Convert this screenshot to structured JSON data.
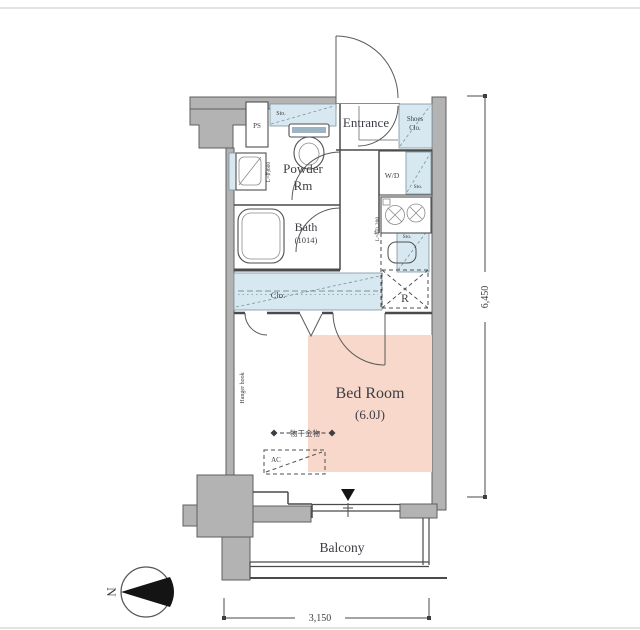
{
  "colors": {
    "wall": "#b3b3b3",
    "line": "#4a4a4a",
    "storage_hatch": "#d7e8f1",
    "bedroom_highlight": "#f8d8ca",
    "page_border": "#d8d8d8",
    "text": "#3d3d45"
  },
  "rooms": {
    "entrance": "Entrance",
    "shoes_closet_line1": "Shoes",
    "shoes_closet_line2": "Clo.",
    "powder_line1": "Powder",
    "powder_line2": "Rm",
    "bath": "Bath",
    "bath_size": "(1014)",
    "bedroom": "Bed Room",
    "bedroom_size": "(6.0J)",
    "balcony": "Balcony",
    "closet": "Clo."
  },
  "fixtures": {
    "pipe_space": "PS",
    "washer_dryer": "W/D",
    "refrigerator": "R",
    "air_conditioner": "AC",
    "storage_above_toilet": "Sto.",
    "storage_above_washer": "Sto.",
    "storage_above_sink": "Sto.",
    "vanity_length": "L=約600",
    "kitchen_length": "L=約1,200",
    "hanger_hook": "Hanger hook",
    "laundry_pole": "物干金物"
  },
  "dimensions": {
    "vertical": "6,450",
    "horizontal": "3,150"
  },
  "compass": {
    "north": "N"
  }
}
